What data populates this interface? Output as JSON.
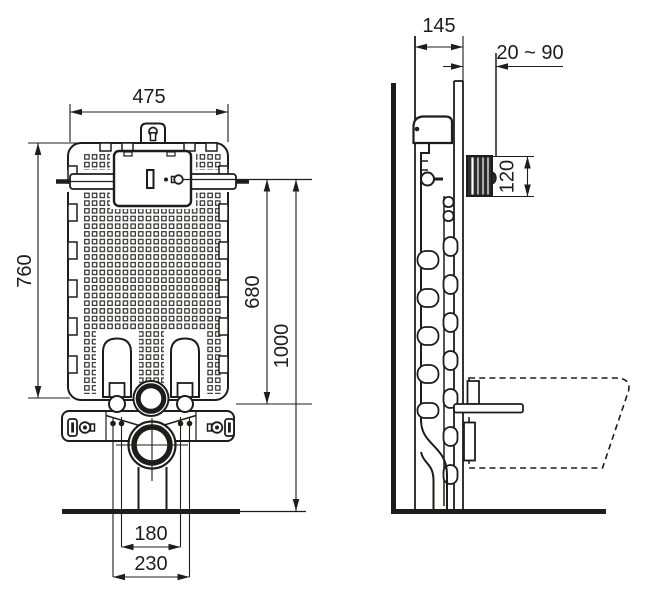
{
  "diagram": {
    "background": "#ffffff",
    "line_color": "#1d1d1b",
    "views": {
      "front": {
        "dimensions": {
          "width": "475",
          "tank_height": "760",
          "flush_pipe_height": "680",
          "overall_height": "1000",
          "bolt_spacing_inner": "180",
          "bolt_spacing_outer": "230"
        }
      },
      "side": {
        "dimensions": {
          "depth": "145",
          "wall_finish_range": "20 ~ 90",
          "access_opening_height": "120"
        }
      }
    }
  }
}
